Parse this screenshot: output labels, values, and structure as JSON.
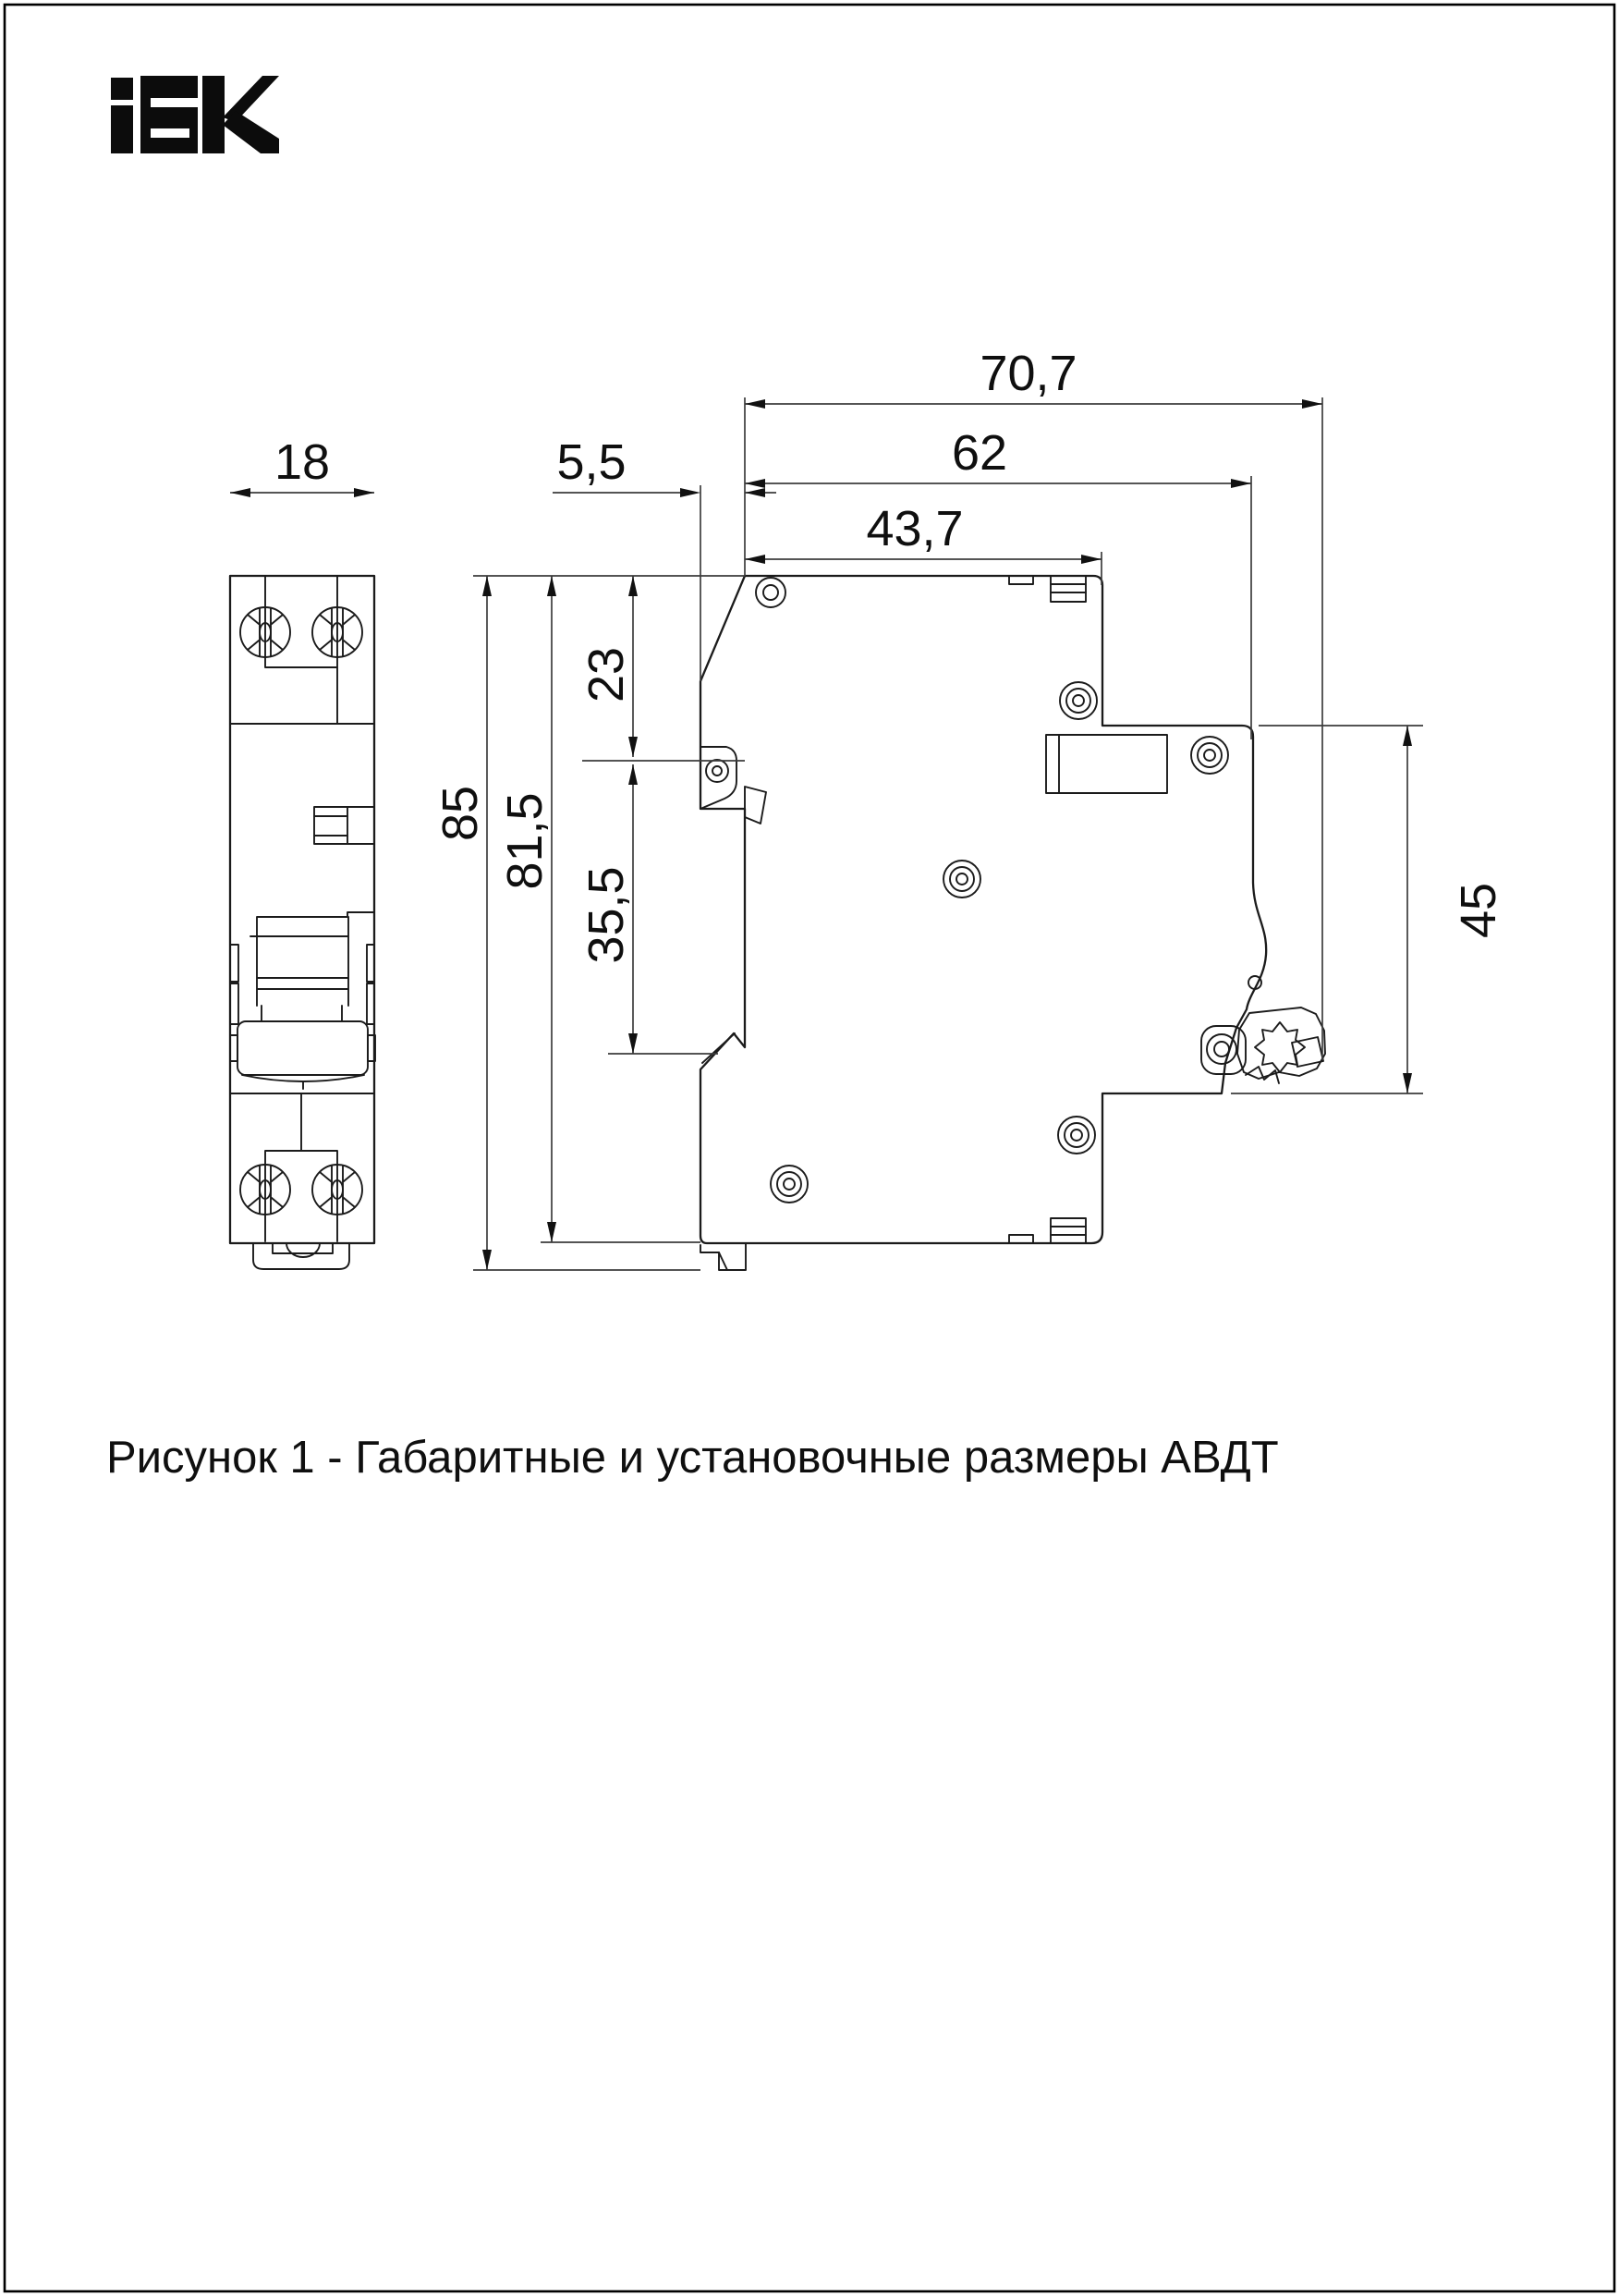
{
  "logo": {
    "alt": "IEK"
  },
  "figure": {
    "caption": "Рисунок 1 - Габаритные и установочные размеры АВДТ"
  },
  "dimensions": {
    "depth_overall": "70,7",
    "depth_to_din_plane": "62",
    "depth_front_block": "43,7",
    "front_lip": "5,5",
    "module_width": "18",
    "top_offset": "23",
    "front_zone_height": "35,5",
    "height_overall": "85",
    "height_body": "81,5",
    "din_section_height": "45"
  },
  "colors": {
    "background": "#ffffff",
    "line": "#1b1b1b",
    "dimension_line": "#3d3d3d",
    "text": "#0f0f0f"
  }
}
